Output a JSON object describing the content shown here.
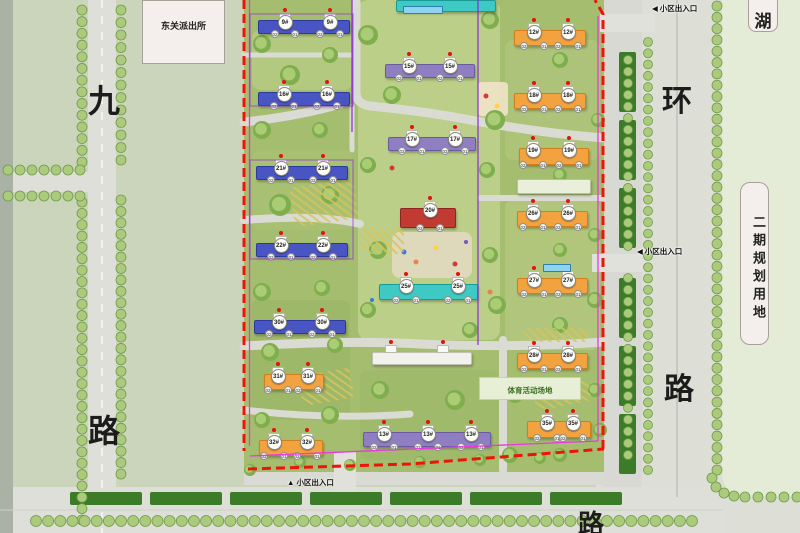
{
  "palette": {
    "buildings": {
      "blue": {
        "fill": "#4a55c4",
        "edge": "#2c3a9e"
      },
      "purple": {
        "fill": "#8f7fc2",
        "edge": "#6a5aa0"
      },
      "teal": {
        "fill": "#3fc9c4",
        "edge": "#189a96"
      },
      "orange": {
        "fill": "#f2a23f",
        "edge": "#d07f1a"
      },
      "red": {
        "fill": "#c23b33",
        "edge": "#8f2420"
      },
      "white": {
        "fill": "#f2f2ec",
        "edge": "#c0c0b6"
      },
      "pale": {
        "fill": "#e9efdb",
        "edge": "#b7c49a"
      }
    },
    "tree_fill": "#abca7c",
    "tree_edge": "#6f9a4a",
    "canopy_outer": "#7fae4e",
    "canopy_inner": "#a9cc74",
    "hedge": "#3c7b28",
    "boundary_red": "#ec1508",
    "boundary_magenta": "#e83ae0",
    "boundary_purple": "#8a2bd8",
    "badge_dot": "#e01410"
  },
  "landmarks": {
    "police_station": "东关派出所",
    "lake": "湖",
    "phase2_site": "二期规划用地",
    "sports_area": "体育活动场地"
  },
  "road_labels": {
    "west": [
      "九",
      "路"
    ],
    "east": [
      "环",
      "路"
    ],
    "south": "路"
  },
  "entrances": {
    "label": "小区出入口",
    "top_marker": "◀",
    "right_marker": "◀",
    "bottom_marker": "▲"
  },
  "unit_labels": [
    "02",
    "01"
  ],
  "buildings": [
    {
      "label": "9#",
      "color": "blue",
      "x": 258,
      "y": 20,
      "w": 92,
      "h": 14,
      "badges": [
        284,
        329
      ]
    },
    {
      "label": "16#",
      "color": "blue",
      "x": 258,
      "y": 92,
      "w": 92,
      "h": 14,
      "badges": [
        283,
        326
      ]
    },
    {
      "label": "21#",
      "color": "blue",
      "x": 256,
      "y": 166,
      "w": 92,
      "h": 14,
      "badges": [
        280,
        322
      ]
    },
    {
      "label": "22#",
      "color": "blue",
      "x": 256,
      "y": 243,
      "w": 92,
      "h": 14,
      "badges": [
        280,
        322
      ]
    },
    {
      "label": "30#",
      "color": "blue",
      "x": 254,
      "y": 320,
      "w": 92,
      "h": 14,
      "badges": [
        278,
        321
      ]
    },
    {
      "label": "31#",
      "color": "orange",
      "x": 264,
      "y": 374,
      "w": 60,
      "h": 16,
      "badges": [
        277,
        307
      ]
    },
    {
      "label": "32#",
      "color": "orange",
      "x": 259,
      "y": 440,
      "w": 64,
      "h": 16,
      "badges": [
        273,
        306
      ]
    },
    {
      "label": "15#",
      "color": "purple",
      "x": 385,
      "y": 64,
      "w": 90,
      "h": 14,
      "badges": [
        408,
        449
      ]
    },
    {
      "label": "17#",
      "color": "purple",
      "x": 388,
      "y": 137,
      "w": 88,
      "h": 14,
      "badges": [
        411,
        454
      ]
    },
    {
      "label": "20#",
      "color": "red",
      "x": 400,
      "y": 208,
      "w": 56,
      "h": 20,
      "badges": [
        429
      ]
    },
    {
      "label": "25#",
      "color": "teal",
      "x": 379,
      "y": 284,
      "w": 99,
      "h": 16,
      "badges": [
        405,
        457
      ]
    },
    {
      "label": "",
      "color": "white",
      "x": 372,
      "y": 352,
      "w": 100,
      "h": 13,
      "badges": [],
      "caps": [
        390,
        442
      ]
    },
    {
      "label": "",
      "color": "teal",
      "x": 396,
      "y": 0,
      "w": 100,
      "h": 12,
      "badges": []
    },
    {
      "label": "12#",
      "color": "orange",
      "x": 514,
      "y": 30,
      "w": 72,
      "h": 16,
      "badges": [
        533,
        567
      ]
    },
    {
      "label": "18#",
      "color": "orange",
      "x": 514,
      "y": 93,
      "w": 72,
      "h": 16,
      "badges": [
        533,
        567
      ]
    },
    {
      "label": "19#",
      "color": "orange",
      "x": 519,
      "y": 148,
      "w": 70,
      "h": 17,
      "badges": [
        532,
        568
      ]
    },
    {
      "label": "",
      "color": "pale",
      "x": 517,
      "y": 179,
      "w": 74,
      "h": 15,
      "badges": []
    },
    {
      "label": "26#",
      "color": "orange",
      "x": 517,
      "y": 211,
      "w": 71,
      "h": 16,
      "badges": [
        532,
        567
      ]
    },
    {
      "label": "27#",
      "color": "orange",
      "x": 517,
      "y": 278,
      "w": 71,
      "h": 16,
      "badges": [
        533,
        567
      ]
    },
    {
      "label": "28#",
      "color": "orange",
      "x": 517,
      "y": 353,
      "w": 71,
      "h": 16,
      "badges": [
        533,
        567
      ]
    },
    {
      "label": "35#",
      "color": "orange",
      "x": 527,
      "y": 421,
      "w": 64,
      "h": 17,
      "badges": [
        546,
        572
      ]
    },
    {
      "label": "13#",
      "color": "purple",
      "x": 363,
      "y": 432,
      "w": 128,
      "h": 15,
      "badges": [
        383,
        427,
        470
      ]
    }
  ]
}
